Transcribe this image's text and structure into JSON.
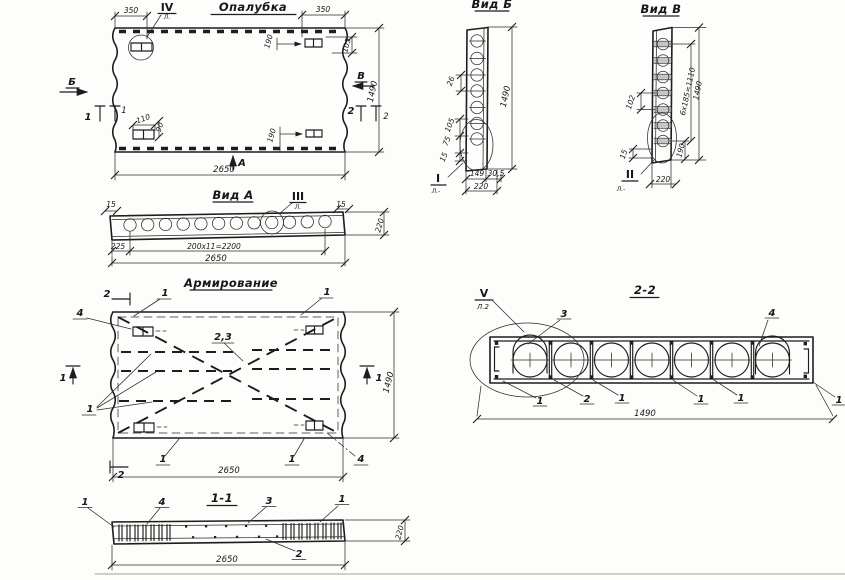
{
  "formwork": {
    "title": "Опалубка",
    "detail_mark": "IV",
    "detail_sheet": "Л.",
    "dim_350_left": "350",
    "dim_350_right": "350",
    "dim_190_top": "190",
    "dim_105_right": "105",
    "dim_110": "110",
    "dim_90": "90",
    "dim_190_bottom": "190",
    "dim_width": "2650",
    "dim_height": "1490",
    "view_left": "Б",
    "view_right": "В",
    "view_bottom": "А",
    "cut_left": "1",
    "cut_left2": "1",
    "cut_right": "2",
    "cut_right2": "2"
  },
  "view_a": {
    "title": "Вид А",
    "detail_mark": "III",
    "detail_sheet": "Л.",
    "dim_15_left": "15",
    "dim_15_right": "15",
    "dim_225": "225",
    "dim_spacing": "200х11=2200",
    "dim_width": "2650",
    "dim_height": "220"
  },
  "view_b": {
    "title": "Вид Б",
    "detail_mark": "I",
    "detail_sheet": "Л.-",
    "dim_26": "26",
    "dim_height": "1490",
    "dim_105": "105",
    "dim_75": "75",
    "dim_15": "15",
    "dim_149": "149",
    "dim_30_5": "30,5",
    "dim_width": "220"
  },
  "view_v": {
    "title": "Вид В",
    "detail_mark": "II",
    "detail_sheet": "Л.-",
    "dim_102": "102",
    "dim_15": "15",
    "dim_190": "190",
    "dim_spacing": "6х185=1110",
    "dim_height": "1490",
    "dim_width": "220"
  },
  "reinforcement": {
    "title": "Армирование",
    "callout_1": "1",
    "callout_2": "2",
    "callout_3": "3",
    "callout_4": "4",
    "callout_23": "2,3",
    "cut_top": "2",
    "cut_bottom": "2",
    "cut_left": "1",
    "cut_right": "1",
    "dim_width": "2650",
    "dim_height": "1490"
  },
  "section_2_2": {
    "title": "2-2",
    "detail_mark": "V",
    "detail_sheet": "Л.2",
    "callout_1": "1",
    "callout_2": "2",
    "callout_3": "3",
    "callout_4": "4",
    "dim_width": "1490"
  },
  "section_1_1": {
    "title": "1-1",
    "callout_1": "1",
    "callout_2": "2",
    "callout_3": "3",
    "callout_4": "4",
    "dim_width": "2650",
    "dim_height": "220"
  }
}
